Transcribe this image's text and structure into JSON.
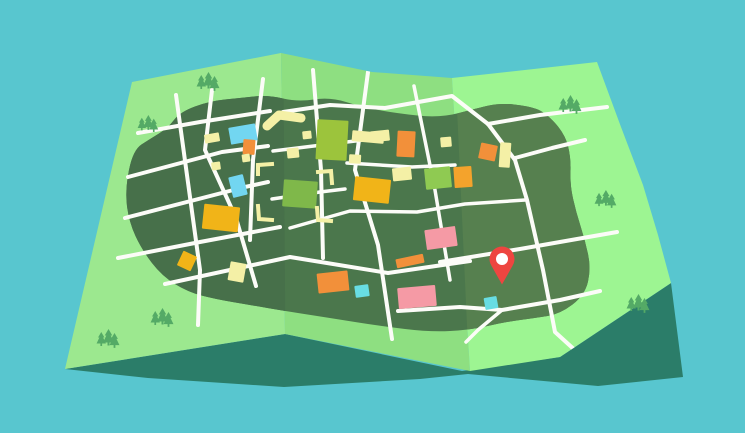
{
  "scene": {
    "width": 745,
    "height": 433,
    "title": "Folded paper map illustration with location pin"
  },
  "colors": {
    "sky": "#58c6cf",
    "shadow": "#2b7d69",
    "panel1": "#9ce88f",
    "panel2": "#8edf81",
    "panel3": "#9df592",
    "land1": "#47704a",
    "land2": "#4b774c",
    "land3": "#56804f",
    "road": "#fcfcf8",
    "tree": "#54aa66",
    "pin": "#ee4540",
    "pin_inner": "#ffffff",
    "cyan": "#72d6f1",
    "cyan2": "#68dde3",
    "orange": "#f2903a",
    "gold": "#f1b418",
    "pale": "#f4f0a6",
    "lime": "#9cc43c",
    "lime2": "#8fca52",
    "green2": "#7fb84a",
    "goldorange": "#f4a32c",
    "pink": "#f59aa5"
  },
  "shadow": {
    "name": "map-cast-shadow",
    "points": [
      [
        65,
        369
      ],
      [
        285,
        334
      ],
      [
        462,
        371
      ],
      [
        560,
        357
      ],
      [
        671,
        283
      ],
      [
        683,
        377
      ],
      [
        598,
        386
      ],
      [
        468,
        374
      ],
      [
        420,
        379
      ],
      [
        284,
        387
      ],
      [
        148,
        378
      ]
    ]
  },
  "panels": [
    {
      "name": "map-panel-left",
      "color_key": "panel1",
      "points": [
        [
          132,
          82
        ],
        [
          281,
          53
        ],
        [
          285,
          334
        ],
        [
          65,
          369
        ]
      ]
    },
    {
      "name": "map-panel-middle",
      "color_key": "panel2",
      "points": [
        [
          281,
          53
        ],
        [
          372,
          72
        ],
        [
          452,
          78
        ],
        [
          470,
          371
        ],
        [
          285,
          334
        ]
      ]
    },
    {
      "name": "map-panel-right",
      "color_key": "panel3",
      "points": [
        [
          452,
          78
        ],
        [
          597,
          62
        ],
        [
          621,
          127
        ],
        [
          643,
          185
        ],
        [
          658,
          235
        ],
        [
          671,
          283
        ],
        [
          560,
          357
        ],
        [
          470,
          371
        ]
      ]
    }
  ],
  "land": {
    "name": "town-land-area",
    "base_color_key": "land2",
    "points": [
      [
        180,
        112
      ],
      [
        210,
        101
      ],
      [
        240,
        98
      ],
      [
        268,
        95
      ],
      [
        298,
        102
      ],
      [
        330,
        97
      ],
      [
        362,
        107
      ],
      [
        395,
        113
      ],
      [
        440,
        118
      ],
      [
        478,
        108
      ],
      [
        500,
        103
      ],
      [
        528,
        106
      ],
      [
        545,
        112
      ],
      [
        565,
        134
      ],
      [
        571,
        158
      ],
      [
        570,
        185
      ],
      [
        576,
        212
      ],
      [
        585,
        240
      ],
      [
        591,
        268
      ],
      [
        585,
        295
      ],
      [
        560,
        314
      ],
      [
        535,
        318
      ],
      [
        505,
        322
      ],
      [
        470,
        330
      ],
      [
        430,
        332
      ],
      [
        380,
        326
      ],
      [
        330,
        318
      ],
      [
        285,
        311
      ],
      [
        250,
        305
      ],
      [
        215,
        299
      ],
      [
        188,
        292
      ],
      [
        162,
        276
      ],
      [
        142,
        250
      ],
      [
        129,
        222
      ],
      [
        125,
        190
      ],
      [
        133,
        150
      ],
      [
        150,
        139
      ],
      [
        168,
        128
      ]
    ],
    "left_overlay": {
      "color_key": "land1",
      "points": [
        [
          0,
          0
        ],
        [
          283,
          0
        ],
        [
          286,
          433
        ],
        [
          0,
          433
        ]
      ]
    },
    "right_overlay": {
      "color_key": "land3",
      "points": [
        [
          452,
          0
        ],
        [
          745,
          0
        ],
        [
          745,
          433
        ],
        [
          472,
          433
        ]
      ]
    }
  },
  "roads": [
    {
      "name": "road",
      "width": 4,
      "points": [
        [
          176,
          95
        ],
        [
          200,
          270
        ],
        [
          198,
          325
        ]
      ]
    },
    {
      "name": "road",
      "width": 4,
      "points": [
        [
          212,
          90
        ],
        [
          205,
          150
        ],
        [
          236,
          218
        ],
        [
          256,
          286
        ]
      ]
    },
    {
      "name": "road",
      "width": 4,
      "points": [
        [
          263,
          79
        ],
        [
          253,
          160
        ],
        [
          250,
          240
        ]
      ]
    },
    {
      "name": "road",
      "width": 4,
      "points": [
        [
          138,
          133
        ],
        [
          200,
          122
        ],
        [
          270,
          111
        ]
      ]
    },
    {
      "name": "road",
      "width": 4,
      "points": [
        [
          128,
          177
        ],
        [
          222,
          152
        ],
        [
          268,
          146
        ]
      ]
    },
    {
      "name": "road",
      "width": 4,
      "points": [
        [
          125,
          218
        ],
        [
          245,
          187
        ],
        [
          268,
          182
        ]
      ]
    },
    {
      "name": "road",
      "width": 4,
      "points": [
        [
          118,
          258
        ],
        [
          200,
          242
        ],
        [
          280,
          227
        ]
      ]
    },
    {
      "name": "road",
      "width": 4,
      "points": [
        [
          165,
          284
        ],
        [
          290,
          257
        ],
        [
          388,
          273
        ],
        [
          470,
          261
        ]
      ]
    },
    {
      "name": "road",
      "width": 4,
      "points": [
        [
          313,
          70
        ],
        [
          321,
          170
        ],
        [
          323,
          258
        ]
      ]
    },
    {
      "name": "road",
      "width": 4,
      "points": [
        [
          368,
          72
        ],
        [
          355,
          170
        ],
        [
          378,
          245
        ],
        [
          392,
          339
        ]
      ]
    },
    {
      "name": "road",
      "width": 3.5,
      "points": [
        [
          414,
          86
        ],
        [
          435,
          190
        ],
        [
          450,
          280
        ]
      ]
    },
    {
      "name": "road",
      "width": 4,
      "points": [
        [
          283,
          112
        ],
        [
          330,
          105
        ],
        [
          385,
          108
        ],
        [
          452,
          96
        ],
        [
          488,
          124
        ]
      ]
    },
    {
      "name": "road",
      "width": 3.5,
      "points": [
        [
          273,
          151
        ],
        [
          330,
          144
        ],
        [
          372,
          139
        ]
      ]
    },
    {
      "name": "road",
      "width": 3.5,
      "points": [
        [
          347,
          163
        ],
        [
          412,
          167
        ],
        [
          455,
          165
        ]
      ]
    },
    {
      "name": "road",
      "width": 3.5,
      "points": [
        [
          272,
          199
        ],
        [
          320,
          192
        ],
        [
          345,
          189
        ]
      ]
    },
    {
      "name": "road",
      "width": 3.5,
      "points": [
        [
          290,
          228
        ],
        [
          350,
          211
        ],
        [
          417,
          212
        ],
        [
          465,
          204
        ],
        [
          525,
          200
        ]
      ]
    },
    {
      "name": "road",
      "width": 4,
      "points": [
        [
          440,
          262
        ],
        [
          520,
          249
        ],
        [
          617,
          232
        ]
      ]
    },
    {
      "name": "road",
      "width": 4,
      "points": [
        [
          488,
          124
        ],
        [
          515,
          160
        ],
        [
          527,
          200
        ],
        [
          543,
          270
        ],
        [
          555,
          332
        ],
        [
          577,
          352
        ]
      ]
    },
    {
      "name": "road",
      "width": 4,
      "points": [
        [
          488,
          124
        ],
        [
          540,
          115
        ],
        [
          607,
          107
        ]
      ]
    },
    {
      "name": "road",
      "width": 4,
      "points": [
        [
          515,
          158
        ],
        [
          552,
          148
        ],
        [
          585,
          140
        ]
      ]
    },
    {
      "name": "road",
      "width": 4,
      "points": [
        [
          398,
          311
        ],
        [
          460,
          307
        ],
        [
          502,
          310
        ],
        [
          560,
          300
        ],
        [
          600,
          291
        ]
      ]
    },
    {
      "name": "road",
      "width": 3.5,
      "points": [
        [
          502,
          310
        ],
        [
          478,
          330
        ],
        [
          466,
          342
        ]
      ]
    }
  ],
  "blocks": [
    {
      "name": "block-cyan",
      "color_key": "cyan",
      "cx": 243,
      "cy": 134,
      "w": 27,
      "h": 17,
      "rot": -10
    },
    {
      "name": "block-orange",
      "color_key": "orange",
      "cx": 249,
      "cy": 147,
      "w": 12,
      "h": 15,
      "rot": 4
    },
    {
      "name": "block-pale",
      "color_key": "pale",
      "cx": 246,
      "cy": 158,
      "w": 8,
      "h": 8,
      "rot": -8
    },
    {
      "name": "block-pale",
      "color_key": "pale",
      "cx": 216,
      "cy": 166,
      "w": 9,
      "h": 8,
      "rot": -8
    },
    {
      "name": "block-pale",
      "color_key": "pale",
      "cx": 212,
      "cy": 138,
      "w": 15,
      "h": 9,
      "rot": -10
    },
    {
      "name": "block-cyan",
      "color_key": "cyan",
      "cx": 238,
      "cy": 186,
      "w": 15,
      "h": 21,
      "rot": -14
    },
    {
      "name": "block-gold",
      "color_key": "gold",
      "cx": 221,
      "cy": 218,
      "w": 36,
      "h": 25,
      "rot": 6
    },
    {
      "name": "block-gold",
      "color_key": "gold",
      "cx": 187,
      "cy": 261,
      "w": 15,
      "h": 16,
      "rot": 25
    },
    {
      "name": "block-pale",
      "color_key": "pale",
      "cx": 237,
      "cy": 272,
      "w": 16,
      "h": 19,
      "rot": 10
    },
    {
      "name": "block-lime",
      "color_key": "lime",
      "cx": 332,
      "cy": 140,
      "w": 31,
      "h": 40,
      "rot": 3
    },
    {
      "name": "block-pale",
      "color_key": "pale",
      "cx": 293,
      "cy": 153,
      "w": 12,
      "h": 10,
      "rot": -6
    },
    {
      "name": "block-pale",
      "color_key": "pale",
      "cx": 307,
      "cy": 135,
      "w": 9,
      "h": 8,
      "rot": -6
    },
    {
      "name": "block-green",
      "color_key": "green2",
      "cx": 300,
      "cy": 194,
      "w": 34,
      "h": 27,
      "rot": 4
    },
    {
      "name": "block-gold",
      "color_key": "gold",
      "cx": 372,
      "cy": 190,
      "w": 36,
      "h": 24,
      "rot": 6
    },
    {
      "name": "block-pale",
      "color_key": "pale",
      "cx": 402,
      "cy": 174,
      "w": 19,
      "h": 13,
      "rot": -6
    },
    {
      "name": "block-pale",
      "color_key": "pale",
      "cx": 368,
      "cy": 137,
      "w": 32,
      "h": 11,
      "rot": 5
    },
    {
      "name": "block-pale",
      "color_key": "pale",
      "cx": 355,
      "cy": 159,
      "w": 12,
      "h": 9,
      "rot": 3
    },
    {
      "name": "block-pale",
      "color_key": "pale",
      "cx": 380,
      "cy": 136,
      "w": 19,
      "h": 11,
      "rot": -6
    },
    {
      "name": "block-lime",
      "color_key": "lime2",
      "cx": 438,
      "cy": 178,
      "w": 26,
      "h": 21,
      "rot": -6
    },
    {
      "name": "block-gold",
      "color_key": "goldorange",
      "cx": 463,
      "cy": 177,
      "w": 18,
      "h": 21,
      "rot": -4
    },
    {
      "name": "block-orange",
      "color_key": "orange",
      "cx": 406,
      "cy": 144,
      "w": 18,
      "h": 26,
      "rot": 3
    },
    {
      "name": "block-pale",
      "color_key": "pale",
      "cx": 446,
      "cy": 142,
      "w": 11,
      "h": 10,
      "rot": -5
    },
    {
      "name": "block-orange",
      "color_key": "orange",
      "cx": 488,
      "cy": 152,
      "w": 17,
      "h": 16,
      "rot": 12
    },
    {
      "name": "block-pale",
      "color_key": "pale",
      "cx": 505,
      "cy": 155,
      "w": 11,
      "h": 25,
      "rot": 4
    },
    {
      "name": "block-pink",
      "color_key": "pink",
      "cx": 441,
      "cy": 238,
      "w": 31,
      "h": 20,
      "rot": -8
    },
    {
      "name": "block-orange",
      "color_key": "orange",
      "cx": 410,
      "cy": 261,
      "w": 28,
      "h": 9,
      "rot": -12
    },
    {
      "name": "block-pink",
      "color_key": "pink",
      "cx": 417,
      "cy": 297,
      "w": 38,
      "h": 21,
      "rot": -5
    },
    {
      "name": "block-cyan",
      "color_key": "cyan2",
      "cx": 491,
      "cy": 303,
      "w": 13,
      "h": 12,
      "rot": -10
    },
    {
      "name": "block-orange",
      "color_key": "orange",
      "cx": 333,
      "cy": 282,
      "w": 31,
      "h": 20,
      "rot": -6
    },
    {
      "name": "block-cyan",
      "color_key": "cyan2",
      "cx": 362,
      "cy": 291,
      "w": 14,
      "h": 12,
      "rot": -8
    }
  ],
  "markers": {
    "chevron": {
      "name": "chevron-mark",
      "color_key": "pale",
      "width": 9,
      "points": [
        [
          267,
          126
        ],
        [
          279,
          115
        ],
        [
          301,
          118
        ]
      ]
    },
    "corner_brackets": [
      {
        "name": "corner-bracket",
        "points": [
          [
            258,
            174
          ],
          [
            258,
            165
          ],
          [
            272,
            164
          ]
        ]
      },
      {
        "name": "corner-bracket",
        "points": [
          [
            258,
            206
          ],
          [
            259,
            219
          ],
          [
            272,
            220
          ]
        ]
      },
      {
        "name": "corner-bracket",
        "points": [
          [
            318,
            172
          ],
          [
            331,
            171
          ],
          [
            332,
            183
          ]
        ]
      },
      {
        "name": "corner-bracket",
        "points": [
          [
            317,
            208
          ],
          [
            318,
            220
          ],
          [
            331,
            221
          ]
        ]
      }
    ],
    "bracket_color_key": "pale",
    "bracket_width": 4
  },
  "trees": {
    "color_key": "tree",
    "clusters": [
      {
        "x": 197,
        "y": 72,
        "s": 1.0
      },
      {
        "x": 138,
        "y": 115,
        "s": 0.9
      },
      {
        "x": 151,
        "y": 308,
        "s": 1.0
      },
      {
        "x": 97,
        "y": 329,
        "s": 1.0
      },
      {
        "x": 559,
        "y": 95,
        "s": 1.0
      },
      {
        "x": 595,
        "y": 190,
        "s": 0.95
      },
      {
        "x": 627,
        "y": 294,
        "s": 1.0
      }
    ]
  },
  "pin": {
    "name": "location-pin",
    "x": 502,
    "y": 259,
    "r": 12.5,
    "inner_r": 6,
    "tip_y": 284.5,
    "color_key": "pin",
    "inner_color_key": "pin_inner"
  }
}
